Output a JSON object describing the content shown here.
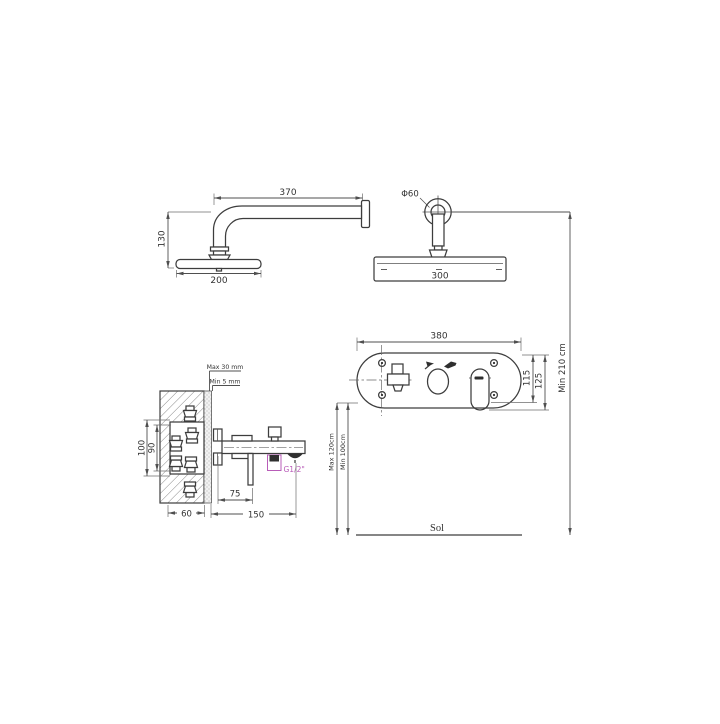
{
  "drawing": {
    "colors": {
      "line": "#3d3d3d",
      "dimension": "#4f4f4f",
      "accent_magenta": "#b85cb8",
      "background": "#ffffff"
    },
    "views": {
      "shower_arm_side": {
        "arm_length": "370",
        "drop_height": "130",
        "head_diameter": "200"
      },
      "shower_head_front": {
        "flange_diameter": "Φ60",
        "head_width": "300"
      },
      "trim_plate": {
        "plate_width": "380",
        "height_inner": "115",
        "height_outer": "125"
      },
      "valve_rough_in": {
        "box_height_outer": "100",
        "box_height_inner": "90",
        "wall_depth": "60",
        "spout_offset": "75",
        "spout_length": "150",
        "finish_max": "Max 30 mm",
        "finish_min": "Min 5 mm",
        "thread_label": "G1/2\""
      },
      "install_heights": {
        "head_height": "Min 210 cm",
        "plate_height_max": "Max 120cm",
        "plate_height_min": "Min 100cm",
        "floor_label": "Sol"
      }
    }
  }
}
